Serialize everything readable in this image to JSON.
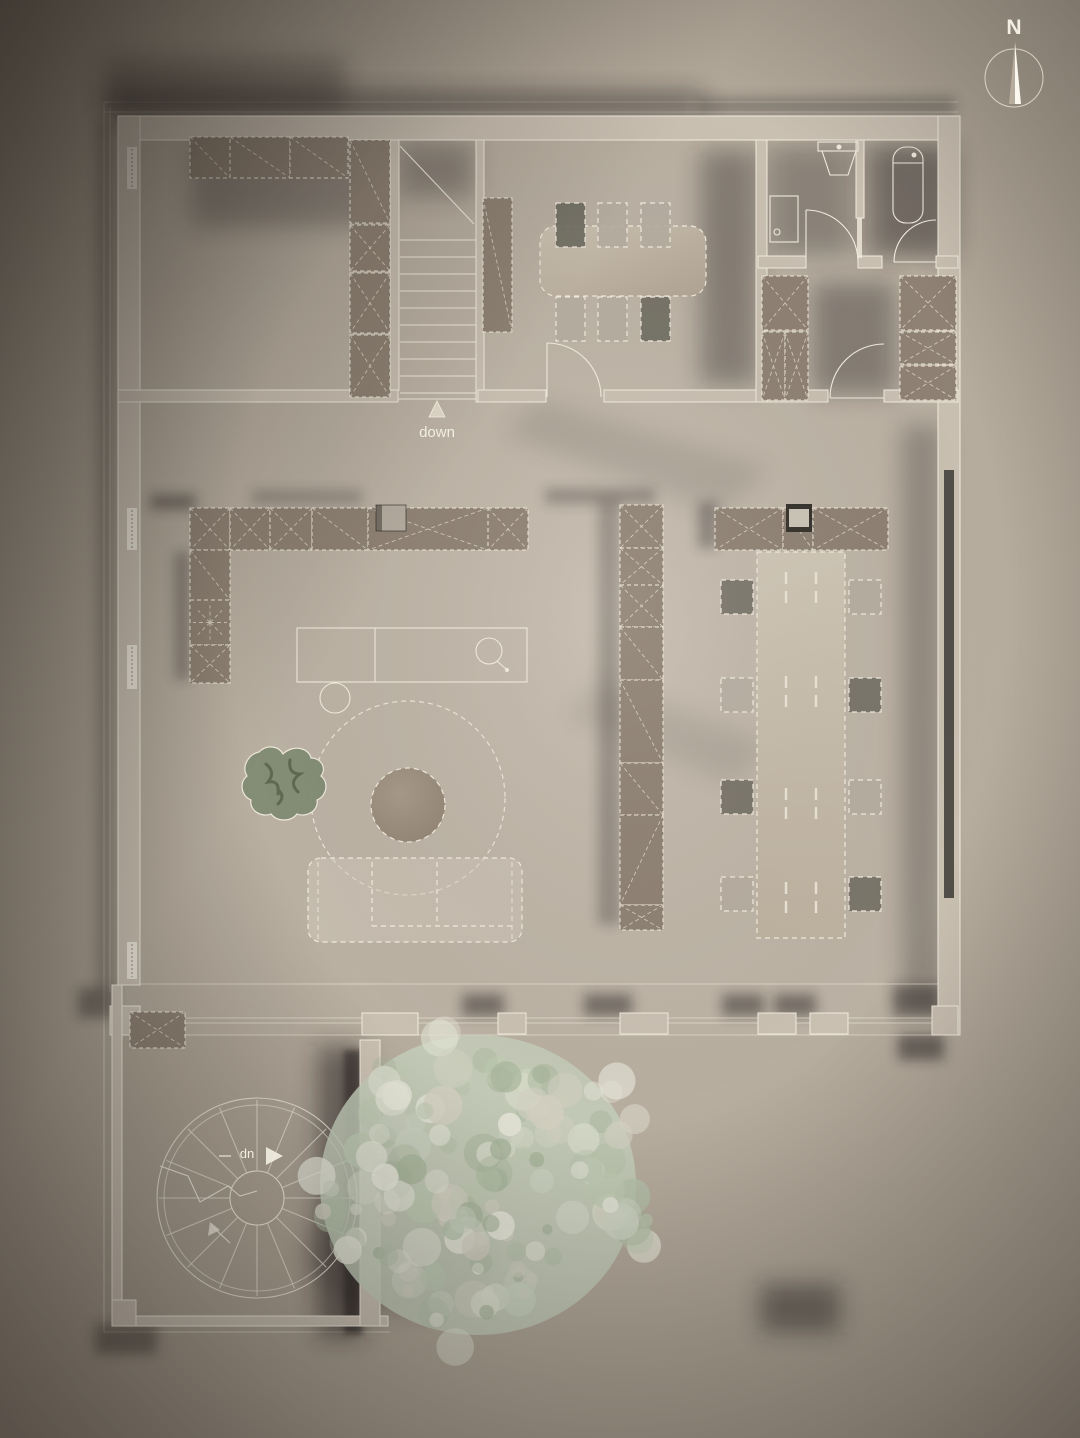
{
  "labels": {
    "north": "N",
    "down": "down",
    "up": "up"
  },
  "colors": {
    "background_center": "#c6bcaf",
    "background_edge": "#8e8478",
    "wall_line": "#f2ecdf",
    "wall_fill": "#cac0b2",
    "floor_tint": "#c9beb0",
    "cabinet_fill": "#8f8274",
    "hatch_line": "#d9d2c3",
    "furniture_light": "#cfc5b5",
    "table_fill": "#c7bcab",
    "chair_dark": "#6e6b60",
    "chair_light": "#b5ada0",
    "coffee_table": "#998c7c",
    "fixture_dark": "#35322c",
    "glazing_dark": "#3d3a35",
    "plant_green": "#828c74",
    "shadow": "#241f1a",
    "label_text": "#f2eee2",
    "north_text": "#e9e2ba",
    "tree_base": "#c4ccba",
    "tree_palette": [
      "#cdd3c2",
      "#b4c0a9",
      "#dcdfce",
      "#a7b49b",
      "#e6e6d9",
      "#bec9b2",
      "#d2cfc0"
    ]
  }
}
